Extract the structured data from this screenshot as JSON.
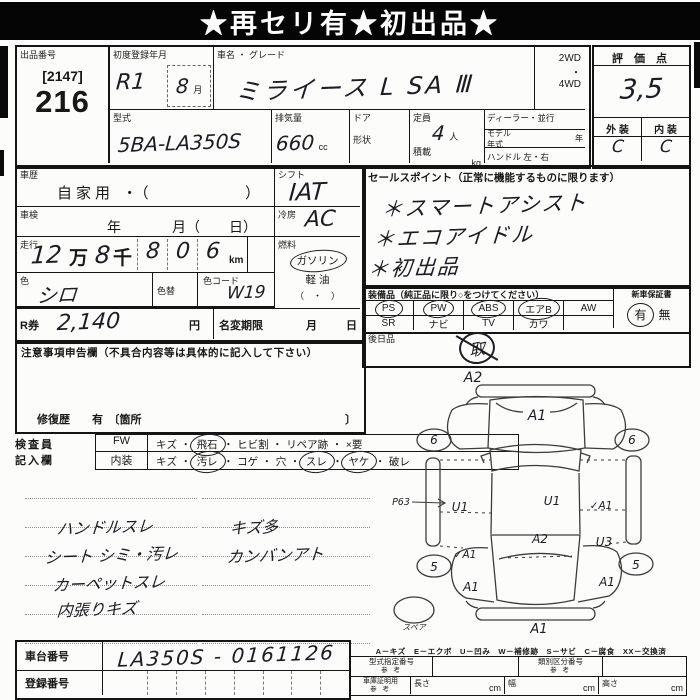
{
  "banner": {
    "title": "★再セリ有★初出品★"
  },
  "header": {
    "lot_label": "出品番号",
    "lot_bracket": "[2147]",
    "lot_number": "216",
    "reg_label": "初度登録年月",
    "reg_value": "R1",
    "reg_month": "8",
    "reg_month_unit": "月",
    "name_label": "車名 ・ グレード",
    "name_value": "ミライース L SA Ⅲ",
    "type_label": "型式",
    "type_value": "5BA-LA350S",
    "disp_label": "排気量",
    "disp_value": "660",
    "disp_unit": "cc",
    "drive_top": "2WD",
    "drive_dot": "・",
    "drive_bottom": "4WD",
    "score_label": "評 価 点",
    "score_value": "3,5",
    "door_label": "ドア",
    "cap_label": "定員",
    "cap_value": "4",
    "cap_unit": "人",
    "dealer_label": "ディーラー・並行",
    "shape_label": "形状",
    "load_label": "積載",
    "load_unit": "kg",
    "model_label": "モデル",
    "model_label2": "年式",
    "model_unit": "年",
    "handle_label": "ハンドル 左・右",
    "ext_label": "外 装",
    "int_label": "内 装",
    "ext_value": "C",
    "int_value": "C"
  },
  "mid": {
    "history_label": "車歴",
    "history_value": "自家用 ・（",
    "history_close": "）",
    "shaken_label": "車検",
    "shaken_year": "年",
    "shaken_month": "月（",
    "shaken_day": "日）",
    "run_label": "走行",
    "run_v1": "12",
    "run_man": "万",
    "run_v2": "8",
    "run_sen": "千",
    "run_digits": [
      "8",
      "0",
      "6"
    ],
    "run_unit": "km",
    "color_label": "色",
    "color_value": "シロ",
    "recolor_label": "色替",
    "code_label": "色コード",
    "code_value": "W19",
    "shift_label": "シフト",
    "shift_value": "IAT",
    "ac_label": "冷房",
    "ac_value": "AC",
    "fuel_label": "燃料",
    "fuel_gas": "ガソリン",
    "fuel_diesel": "軽 油",
    "fuel_paren": "（　・　）",
    "rticket_label": "R券",
    "rticket_value": "2,140",
    "rticket_unit": "円",
    "nc_label": "名変期限",
    "nc_month": "月",
    "nc_day": "日"
  },
  "sales": {
    "label": "セールスポイント（正常に機能するものに限ります）",
    "lines": [
      "＊スマートアシスト",
      "＊エコアイドル",
      "＊初出品"
    ]
  },
  "equip": {
    "label": "装備品（純正品に限り○をつけてください）",
    "row1": [
      {
        "t": "PS",
        "c": true
      },
      {
        "t": "PW",
        "c": true
      },
      {
        "t": "ABS",
        "c": true
      },
      {
        "t": "エアB",
        "c": true
      },
      {
        "t": "AW",
        "c": false
      }
    ],
    "row2": [
      {
        "t": "SR",
        "c": false
      },
      {
        "t": "ナビ",
        "c": false
      },
      {
        "t": "TV",
        "c": false
      },
      {
        "t": "カワ",
        "c": false
      },
      {
        "t": "",
        "c": false
      }
    ],
    "warranty_label": "新車保証書",
    "warranty_yes": "有",
    "warranty_no": "無",
    "later_label": "後日品",
    "later_value": "取"
  },
  "caution": {
    "label": "注意事項申告欄（不具合内容等は具体的に記入して下さい）",
    "repair_text": "修復歴　　有　〔箇所",
    "repair_close": "〕"
  },
  "inspector": {
    "row_label1": "検査員",
    "row_label2": "記入欄",
    "fw_label": "FW",
    "fw_items": [
      {
        "t": "キズ",
        "c": false
      },
      {
        "t": "飛石",
        "c": true
      },
      {
        "t": "ヒビ割",
        "c": false
      },
      {
        "t": "リペア跡",
        "c": false
      },
      {
        "t": "×要",
        "c": false
      }
    ],
    "int_label": "内装",
    "int_items": [
      {
        "t": "キズ",
        "c": false
      },
      {
        "t": "汚レ",
        "c": true
      },
      {
        "t": "コゲ",
        "c": false
      },
      {
        "t": "穴",
        "c": false
      },
      {
        "t": "スレ",
        "c": true
      },
      {
        "t": "ヤケ",
        "c": true
      },
      {
        "t": "破レ",
        "c": false
      }
    ]
  },
  "notes": {
    "left": [
      "ハンドルスレ",
      "シート シミ・汚レ",
      "カーペットスレ",
      "内張りキズ"
    ],
    "right": [
      "キズ多",
      "カンバンアト"
    ]
  },
  "diagram": {
    "legend": "A－キズ　E－エクボ　U－凹み　W－補修跡　S－サビ　C－腐食　XX－交換済",
    "annotations": [
      {
        "t": "A2",
        "x": 105,
        "y": 30,
        "fs": 14
      },
      {
        "t": "A1",
        "x": 169,
        "y": 68,
        "fs": 14
      },
      {
        "t": "6",
        "x": 66,
        "y": 92,
        "fs": 12
      },
      {
        "t": "6",
        "x": 264,
        "y": 92,
        "fs": 12
      },
      {
        "t": "P63",
        "x": 33,
        "y": 153,
        "fs": 9.5
      },
      {
        "t": "U1",
        "x": 92,
        "y": 159,
        "fs": 12
      },
      {
        "t": "U1",
        "x": 184,
        "y": 153,
        "fs": 12
      },
      {
        "t": "✓A1",
        "x": 233,
        "y": 157,
        "fs": 10.5
      },
      {
        "t": "A2",
        "x": 172,
        "y": 191,
        "fs": 12
      },
      {
        "t": "U3",
        "x": 236,
        "y": 194,
        "fs": 12
      },
      {
        "t": "✓A1",
        "x": 97,
        "y": 206,
        "fs": 10.5
      },
      {
        "t": "5",
        "x": 66,
        "y": 219,
        "fs": 12
      },
      {
        "t": "5",
        "x": 268,
        "y": 217,
        "fs": 12
      },
      {
        "t": "A1",
        "x": 103,
        "y": 239,
        "fs": 12
      },
      {
        "t": "A1",
        "x": 239,
        "y": 234,
        "fs": 12
      },
      {
        "t": "A1",
        "x": 171,
        "y": 281,
        "fs": 13
      },
      {
        "t": "スペア",
        "x": 46,
        "y": 278,
        "fs": 8
      }
    ]
  },
  "bottom": {
    "chassis_label": "車台番号",
    "chassis_value": "LA350S - 0161126",
    "reg_label": "登録番号",
    "type_ref_label": "型式指定番号",
    "type_ref_sub": "参 考",
    "class_ref_label": "類別区分番号",
    "class_ref_sub": "参 考",
    "garage_label": "車庫証明用",
    "garage_sub": "参 考",
    "len_label": "長さ",
    "wid_label": "幅",
    "hei_label": "高さ",
    "cm": "cm"
  }
}
